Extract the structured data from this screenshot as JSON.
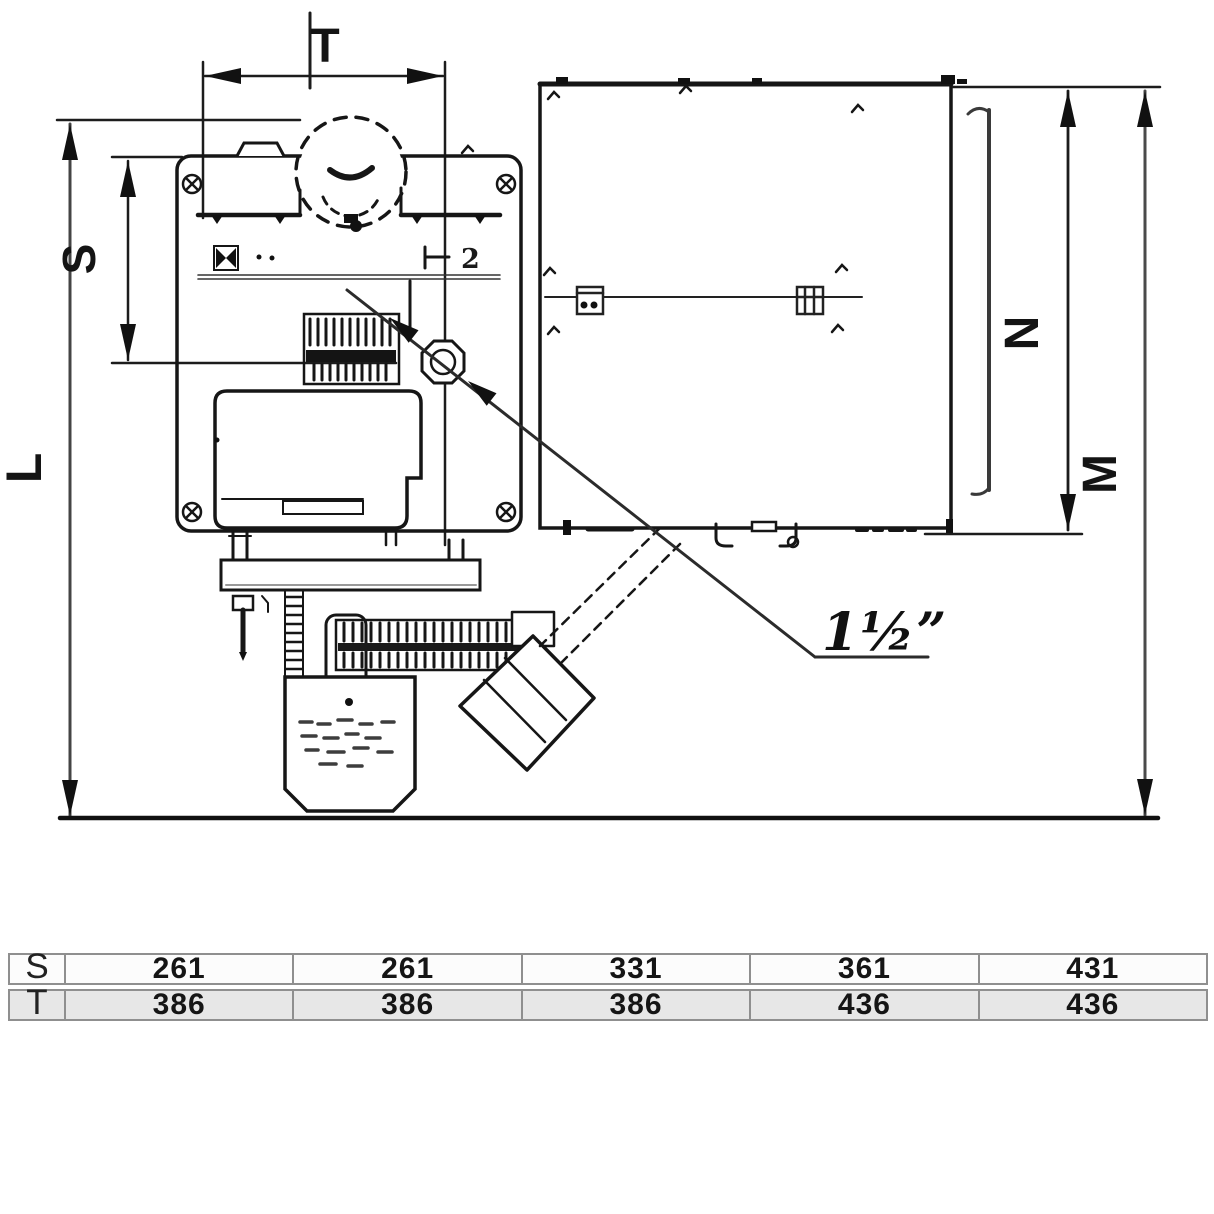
{
  "drawing": {
    "dimension_labels": {
      "top_width": "T",
      "left_inner": "S",
      "left_overall": "L",
      "right_inner": "N",
      "right_overall": "M"
    },
    "connection_size_label": "1½”",
    "body_mark": "2"
  },
  "table": {
    "rows": [
      {
        "header": "S",
        "values": [
          "261",
          "261",
          "331",
          "361",
          "431"
        ]
      },
      {
        "header": "T",
        "values": [
          "386",
          "386",
          "386",
          "436",
          "436"
        ]
      }
    ]
  },
  "colors": {
    "ink": "#161616",
    "gray_line": "#555555",
    "table_border": "#8f8f8f",
    "table_alt_row_bg": "#e7e7e7",
    "background": "#ffffff"
  }
}
